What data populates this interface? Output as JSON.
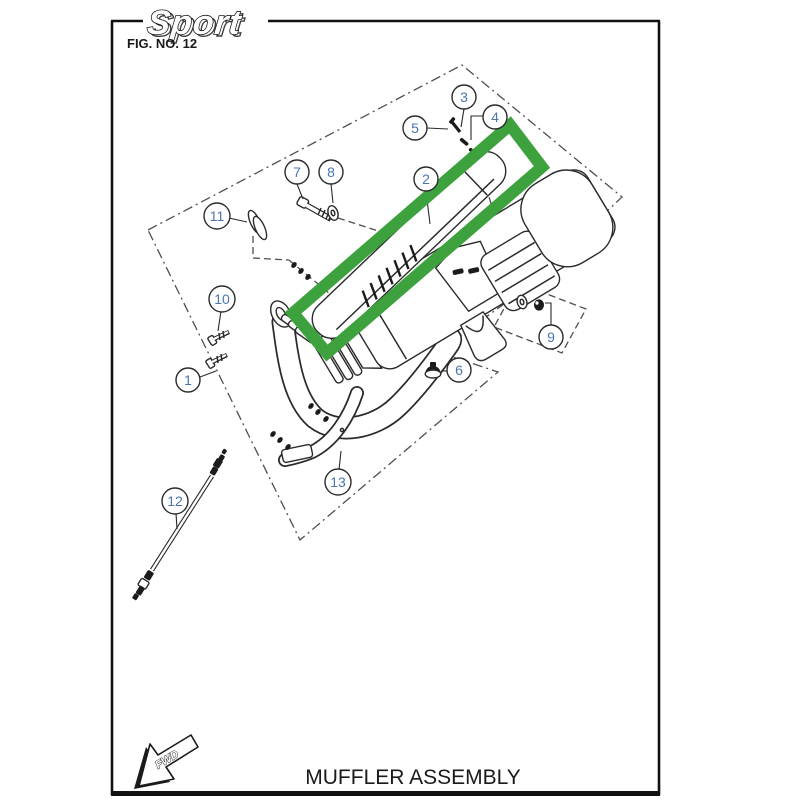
{
  "page": {
    "brand_logo": "Sport",
    "fig_label": "FIG. NO. 12",
    "title": "MUFFLER ASSEMBLY",
    "fwd_label": "FWD"
  },
  "diagram": {
    "description": "Exploded parts view of a muffler assembly with numbered callouts",
    "highlight": {
      "shape": "rotated-rectangle",
      "color": "#3da23d",
      "around_part": "2"
    },
    "callout_number_color": "#4a76b0",
    "callouts": [
      {
        "n": "1"
      },
      {
        "n": "2"
      },
      {
        "n": "3"
      },
      {
        "n": "4"
      },
      {
        "n": "5"
      },
      {
        "n": "6"
      },
      {
        "n": "7"
      },
      {
        "n": "8"
      },
      {
        "n": "9"
      },
      {
        "n": "10"
      },
      {
        "n": "11"
      },
      {
        "n": "12"
      },
      {
        "n": "13"
      }
    ]
  }
}
